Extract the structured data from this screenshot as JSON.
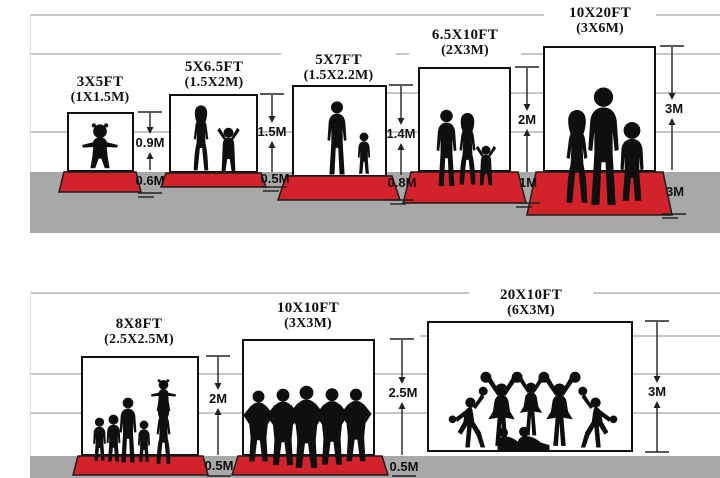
{
  "diagram_title": "Backdrop size comparison with human silhouettes",
  "colors": {
    "carpet_red": "#d2232a",
    "floor_gray": "#a8a8a8",
    "grid_line_gray": "#c6c6c6",
    "silhouette_black": "#0f0f0f",
    "text_black": "#101010"
  },
  "sections": [
    {
      "panels": [
        {
          "ft": "3X5FT",
          "m": "(1X1.5M)",
          "top_dim": "0.9M",
          "bottom_dim": "0.6M"
        },
        {
          "ft": "5X6.5FT",
          "m": "(1.5X2M)",
          "top_dim": "1.5M",
          "bottom_dim": "0.5M"
        },
        {
          "ft": "5X7FT",
          "m": "(1.5X2.2M)",
          "top_dim": "1.4M",
          "bottom_dim": "0.8M"
        },
        {
          "ft": "6.5X10FT",
          "m": "(2X3M)",
          "top_dim": "2M",
          "bottom_dim": "1M"
        },
        {
          "ft": "10X20FT",
          "m": "(3X6M)",
          "top_dim": "3M",
          "bottom_dim": "3M"
        }
      ]
    },
    {
      "panels": [
        {
          "ft": "8X8FT",
          "m": "(2.5X2.5M)",
          "top_dim": "2M",
          "bottom_dim": "0.5M"
        },
        {
          "ft": "10X10FT",
          "m": "(3X3M)",
          "top_dim": "2.5M",
          "bottom_dim": "0.5M"
        },
        {
          "ft": "20X10FT",
          "m": "(6X3M)",
          "top_dim": "3M"
        }
      ]
    }
  ]
}
